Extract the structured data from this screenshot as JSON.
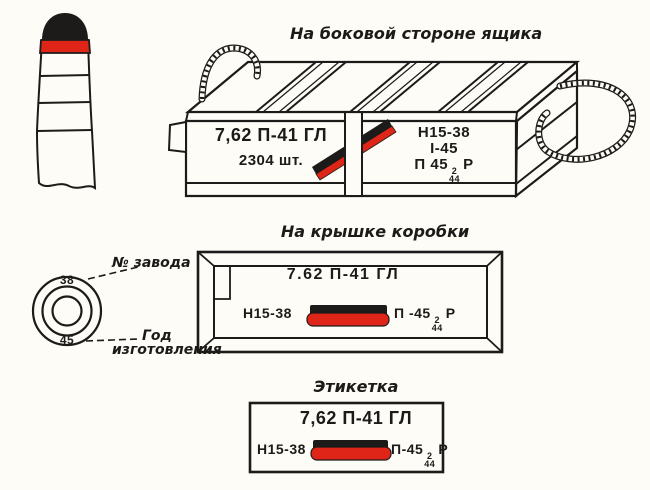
{
  "titles": {
    "side": "На боковой стороне ящика",
    "lid": "На крышке коробки",
    "label": "Этикетка"
  },
  "crate_markings": {
    "left_panel": {
      "caliber": "7,62 П-41 ГЛ",
      "quantity": "2304 шт."
    },
    "right_panel": {
      "lot": "Н15-38",
      "date": "I-45",
      "powder_prefix": "П 45",
      "powder_sup": "2",
      "powder_sub": "44",
      "powder_suffix": "Р"
    }
  },
  "cartridge_base": {
    "factory_number": "38",
    "year": "45",
    "factory_label": "№ завода",
    "year_label_line1": "Год",
    "year_label_line2": "изготовления"
  },
  "lid_markings": {
    "caliber": "7.62 П-41 ГЛ",
    "lot": "Н15-38",
    "powder_prefix": "П -45",
    "powder_sup": "2",
    "powder_sub": "44",
    "powder_suffix": "Р"
  },
  "label_markings": {
    "caliber": "7,62 П-41 ГЛ",
    "lot": "Н15-38",
    "powder_prefix": "П-45",
    "powder_sup": "2",
    "powder_sub": "44",
    "powder_suffix": "Р"
  },
  "colors": {
    "ink": "#1d1b19",
    "red": "#df2517",
    "paper": "#fdfcf6"
  }
}
